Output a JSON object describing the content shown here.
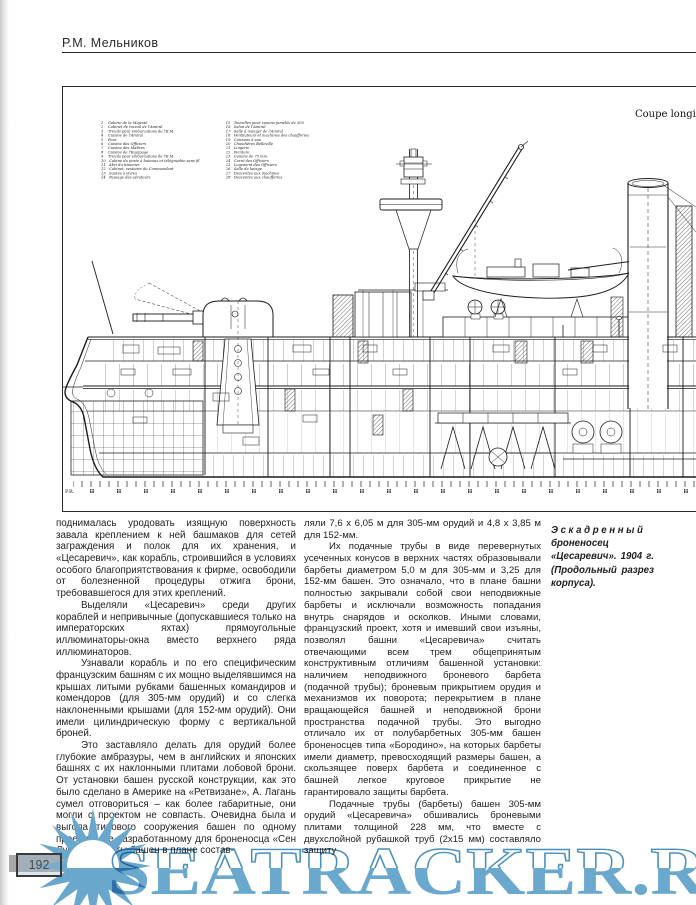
{
  "page": {
    "header": "Р.М. Мельников",
    "page_number": "192",
    "watermark": "SEATRACKER.RU"
  },
  "drawing": {
    "section_label": "Coupe longitudinale",
    "pr_label": "P.R.",
    "legend_col1": [
      "1    Galerie de la Majesté",
      "2    Cabinet de travail de l'Amiral",
      "3    Treuils pour embarcations de l'E.M.",
      "4    Cuisine de l'Amiral",
      "5    Four",
      "6    Cuisine des Officiers",
      "7    Cuisine des Maîtres",
      "8    Cuisine de l'Équipage",
      "9    Treuils pour embarcations de l'E.M.",
      "10   Cabine du poste à bateaux et télégraphie sans fil",
      "11   Abri du timonier",
      "12   Cabinet, vestiaire du Commandant",
      "13   Soutes à vivres",
      "14   Passage des aérateurs"
    ],
    "legend_col2": [
      "15   Tourelles pour canons jumelés de 305",
      "16   Salon de l'Amiral",
      "17   Salle à manger de l'Amiral",
      "18   Ventilateurs et machines des chaufferies",
      "19   Caissons à eau",
      "20   Chaudières Belleville",
      "21   Lingerie",
      "22   Peinture",
      "23   Canons de 75 mm",
      "24   Carré des Officiers",
      "25   Logement des Officiers",
      "26   Salle de lavage",
      "27   Descentes aux machines",
      "28   Descentes aux chaufferies"
    ]
  },
  "article": {
    "left_column": [
      "поднималась уродовать изящную поверхность завала креплением к ней башмаков для сетей заграждения и полок для их хранения, и «Цесаревич», как корабль, строившийся в условиях особого благоприятствования к фирме, освободили от болезненной процедуры отжига брони, требовавшегося для этих креплений.",
      "Выделяли «Цесаревич» среди других кораблей и непривычные (допускавшиеся только на императорских яхтах) прямоугольные иллюминаторы-окна вместо верхнего ряда иллюминаторов.",
      "Узнавали корабль и по его специфическим французским башням с их мощно выделявшимся на крышах литыми рубками башенных командиров и комендоров (для 305-мм орудий) и со слегка наклоненными крышами (для 152-мм орудий). Они имели цилиндрическую форму с вертикальной броней.",
      "Это заставляло делать для орудий более глубокие амбразуры, чем в английских и японских башнях с их наклонными плитами лобовой брони. От установки башен русской конструкции, как это было сделано в Америке на «Ретвизане», А. Лагань сумел отговориться – как более габаритные, они могли с проектом не совпасть. Очевидна была и выгода типового сооружения башен по одному проекту, уже разработанному для броненосца «Сен Луи». Габариты башен в плане состав-"
    ],
    "right_column": [
      "ляли 7,6 х 6,05 м для 305-мм орудий и 4,8 х 3,85 м для 152-мм.",
      "Их подачные трубы в виде перевернутых усеченных конусов в верхних частях образовывали барбеты диаметром 5,0 м для 305-мм и 3,25 для 152-мм башен. Это означало, что в плане башни полностью закрывали собой свои неподвижные барбеты и исключали возможность попадания внутрь снарядов и осколков. Иными словами, французский проект, хотя и имевший свои изъяны, позволял башни «Цесаревича» считать отвечающими всем трем общепринятым конструктивным отличиям башенной установки: наличием неподвижного броневого барбета (подачной трубы); броневым прикрытием орудия и механизмов их поворота; перекрытием в плане вращающейся башней и неподвижной брони пространства подачной трубы. Это выгодно отличало их от полубарбетных 305-мм башен броненосцев типа «Бородино», на которых барбеты имели диаметр, превосходящий размеры башен, а скользящее поверх барбета и соединенное с башней легкое круговое прикрытие не гарантировало защиты барбета.",
      "Подачные трубы (барбеты) башен 305-мм орудий «Цесаревича» обшивались броневыми плитами толщиной 228 мм, что вместе с двухслойной рубашкой труб (2х15 мм) составляло защиту"
    ],
    "caption": {
      "lead": "Эскадренный",
      "rest": "броненосец «Цесаревич». 1904 г. (Продольный разрез корпуса)."
    }
  },
  "colors": {
    "watermark_blue": "#6aa8ce",
    "watermark_outline": "#4a90bd",
    "ink": "#1c1c1c"
  }
}
